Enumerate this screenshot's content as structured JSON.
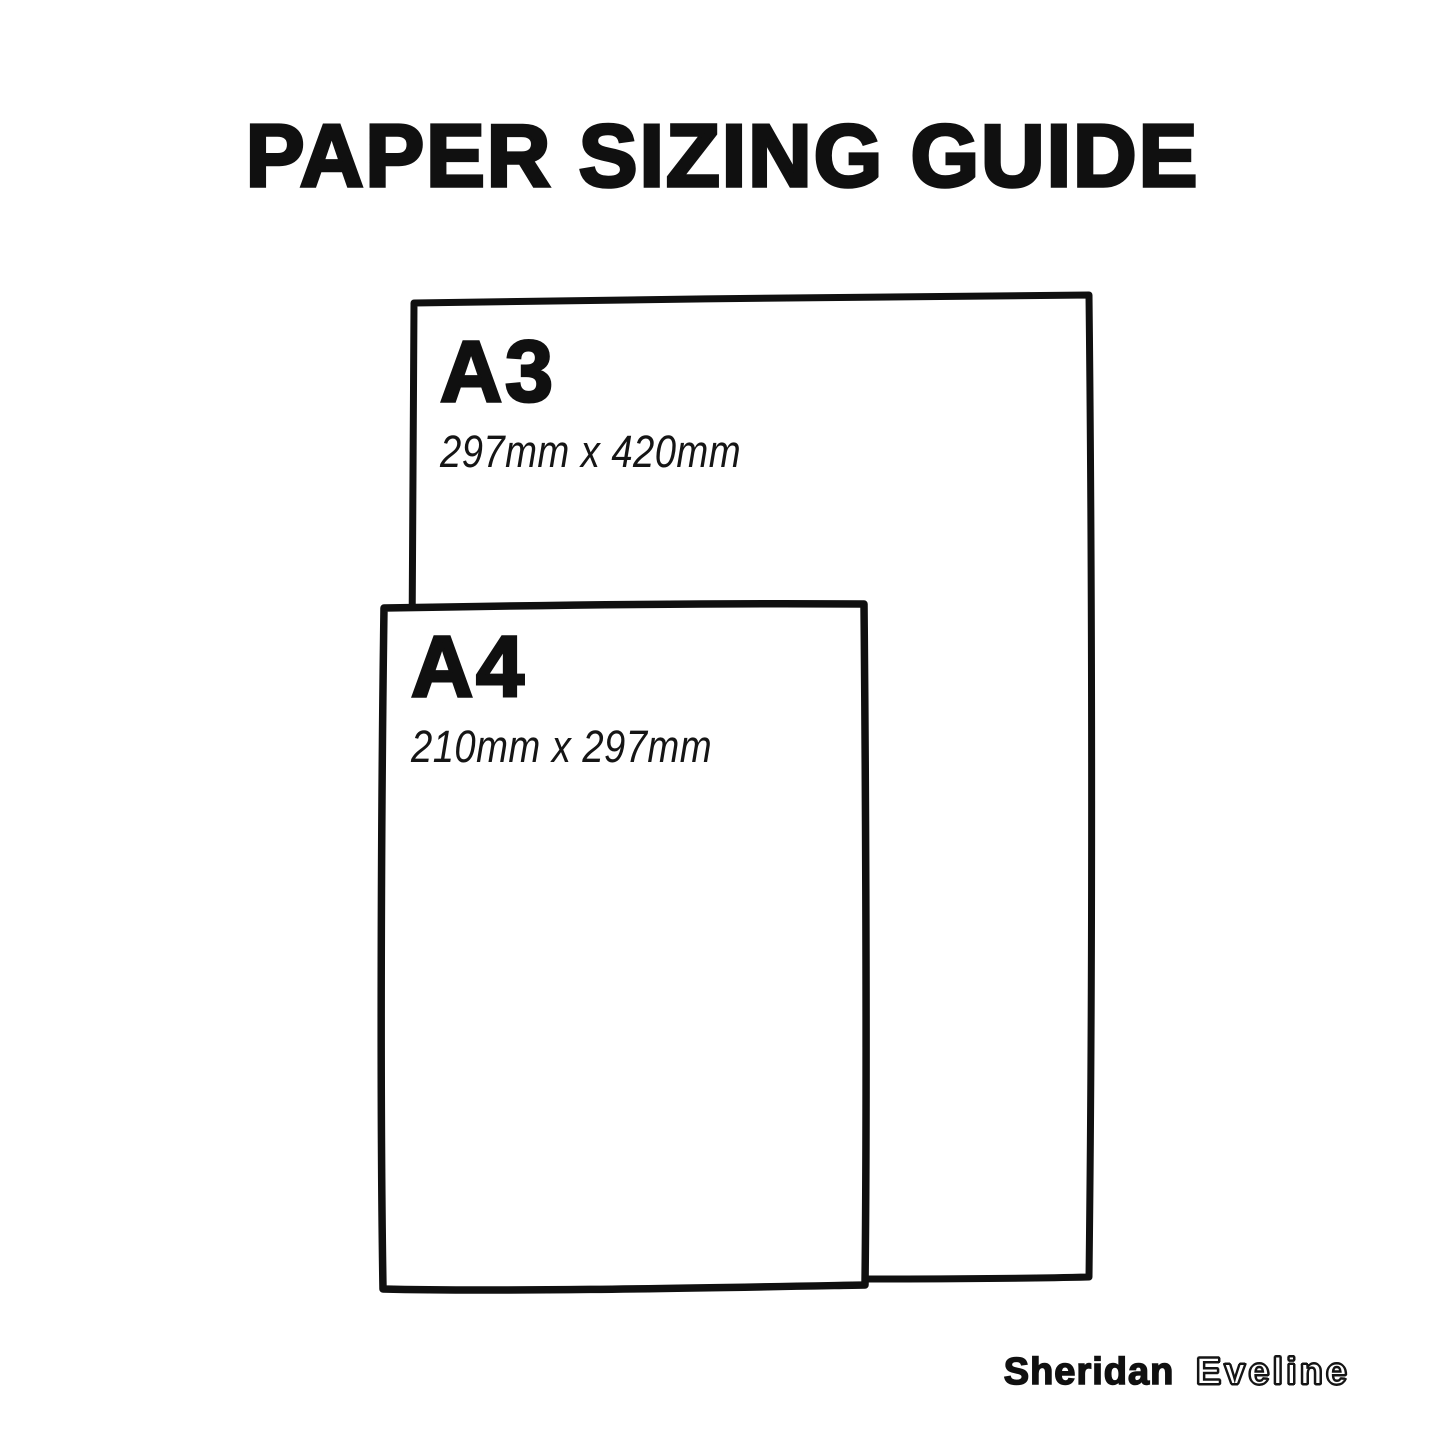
{
  "title": "PAPER SIZING GUIDE",
  "papers": [
    {
      "id": "a3",
      "label": "A3",
      "dimensions": "297mm x 420mm"
    },
    {
      "id": "a4",
      "label": "A4",
      "dimensions": "210mm x 297mm"
    }
  ],
  "branding": {
    "first_name": "Sheridan",
    "last_name": "Eveline"
  },
  "colors": {
    "background": "#ffffff",
    "ink": "#101010"
  }
}
